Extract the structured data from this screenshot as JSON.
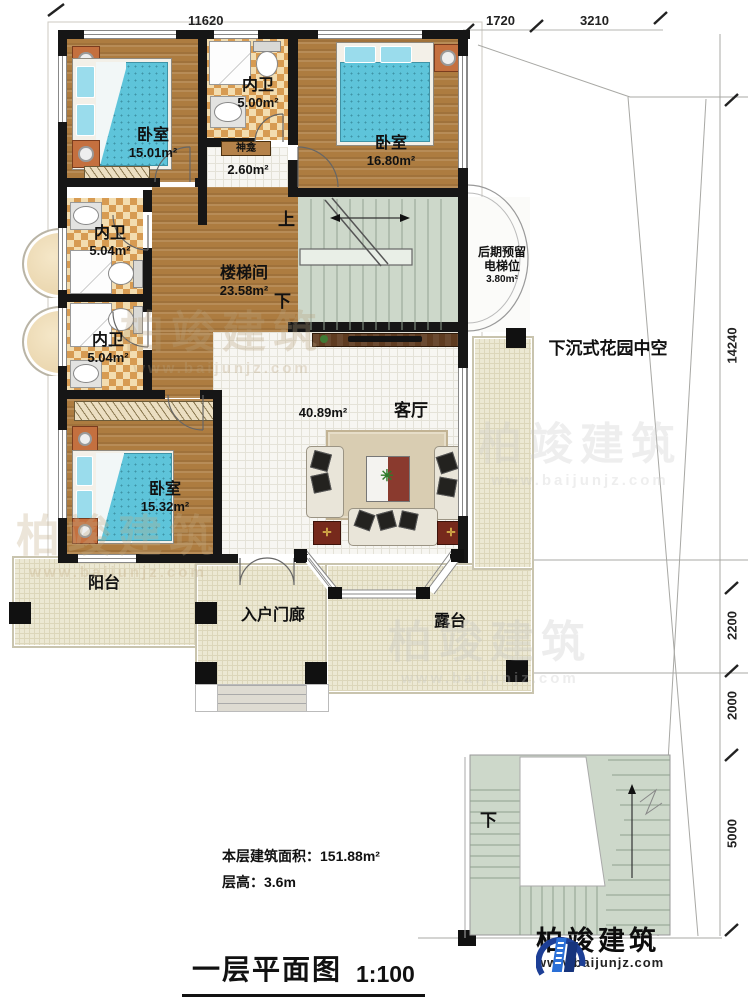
{
  "title": {
    "main": "一层平面图",
    "scale": "1:100"
  },
  "info": {
    "area_line": "本层建筑面积：151.88m²",
    "height_line": "层高：3.6m"
  },
  "dimensions": {
    "top": [
      "11620",
      "1720",
      "3210"
    ],
    "right": [
      "14240",
      "2200",
      "2000",
      "5000"
    ]
  },
  "rooms": {
    "bedroom_tl": {
      "name": "卧室",
      "area": "15.01m²"
    },
    "bath_top": {
      "name": "内卫",
      "area": "5.00m²"
    },
    "shrine": {
      "name": "神龛",
      "area": "2.60m²"
    },
    "bedroom_tr": {
      "name": "卧室",
      "area": "16.80m²"
    },
    "stair_hall": {
      "name": "楼梯间",
      "area": "23.58m²"
    },
    "bath_mid": {
      "name": "内卫",
      "area": "5.04m²"
    },
    "bath_low": {
      "name": "内卫",
      "area": "5.04m²"
    },
    "bedroom_bl": {
      "name": "卧室",
      "area": "15.32m²"
    },
    "living": {
      "name": "客厅",
      "area": "40.89m²"
    },
    "elevator": {
      "line1": "后期预留",
      "line2": "电梯位",
      "area": "3.80m²"
    },
    "balcony": {
      "name": "阳台"
    },
    "porch": {
      "name": "入户门廊"
    },
    "terrace": {
      "name": "露台"
    },
    "garden": {
      "name": "下沉式花园中空"
    }
  },
  "stairs": {
    "up": "上",
    "down": "下",
    "outdoor_down": "下"
  },
  "watermark": {
    "text": "柏竣建筑",
    "url": "www.baijunjz.com"
  },
  "logo": {
    "text": "柏竣建筑",
    "url": "www.baijunjz.com"
  },
  "colors": {
    "accent_blue": "#1d55b8",
    "wood": "#ad7c40",
    "stair_green": "#cdd8ca",
    "outdoor_beige": "#ece8d3"
  }
}
